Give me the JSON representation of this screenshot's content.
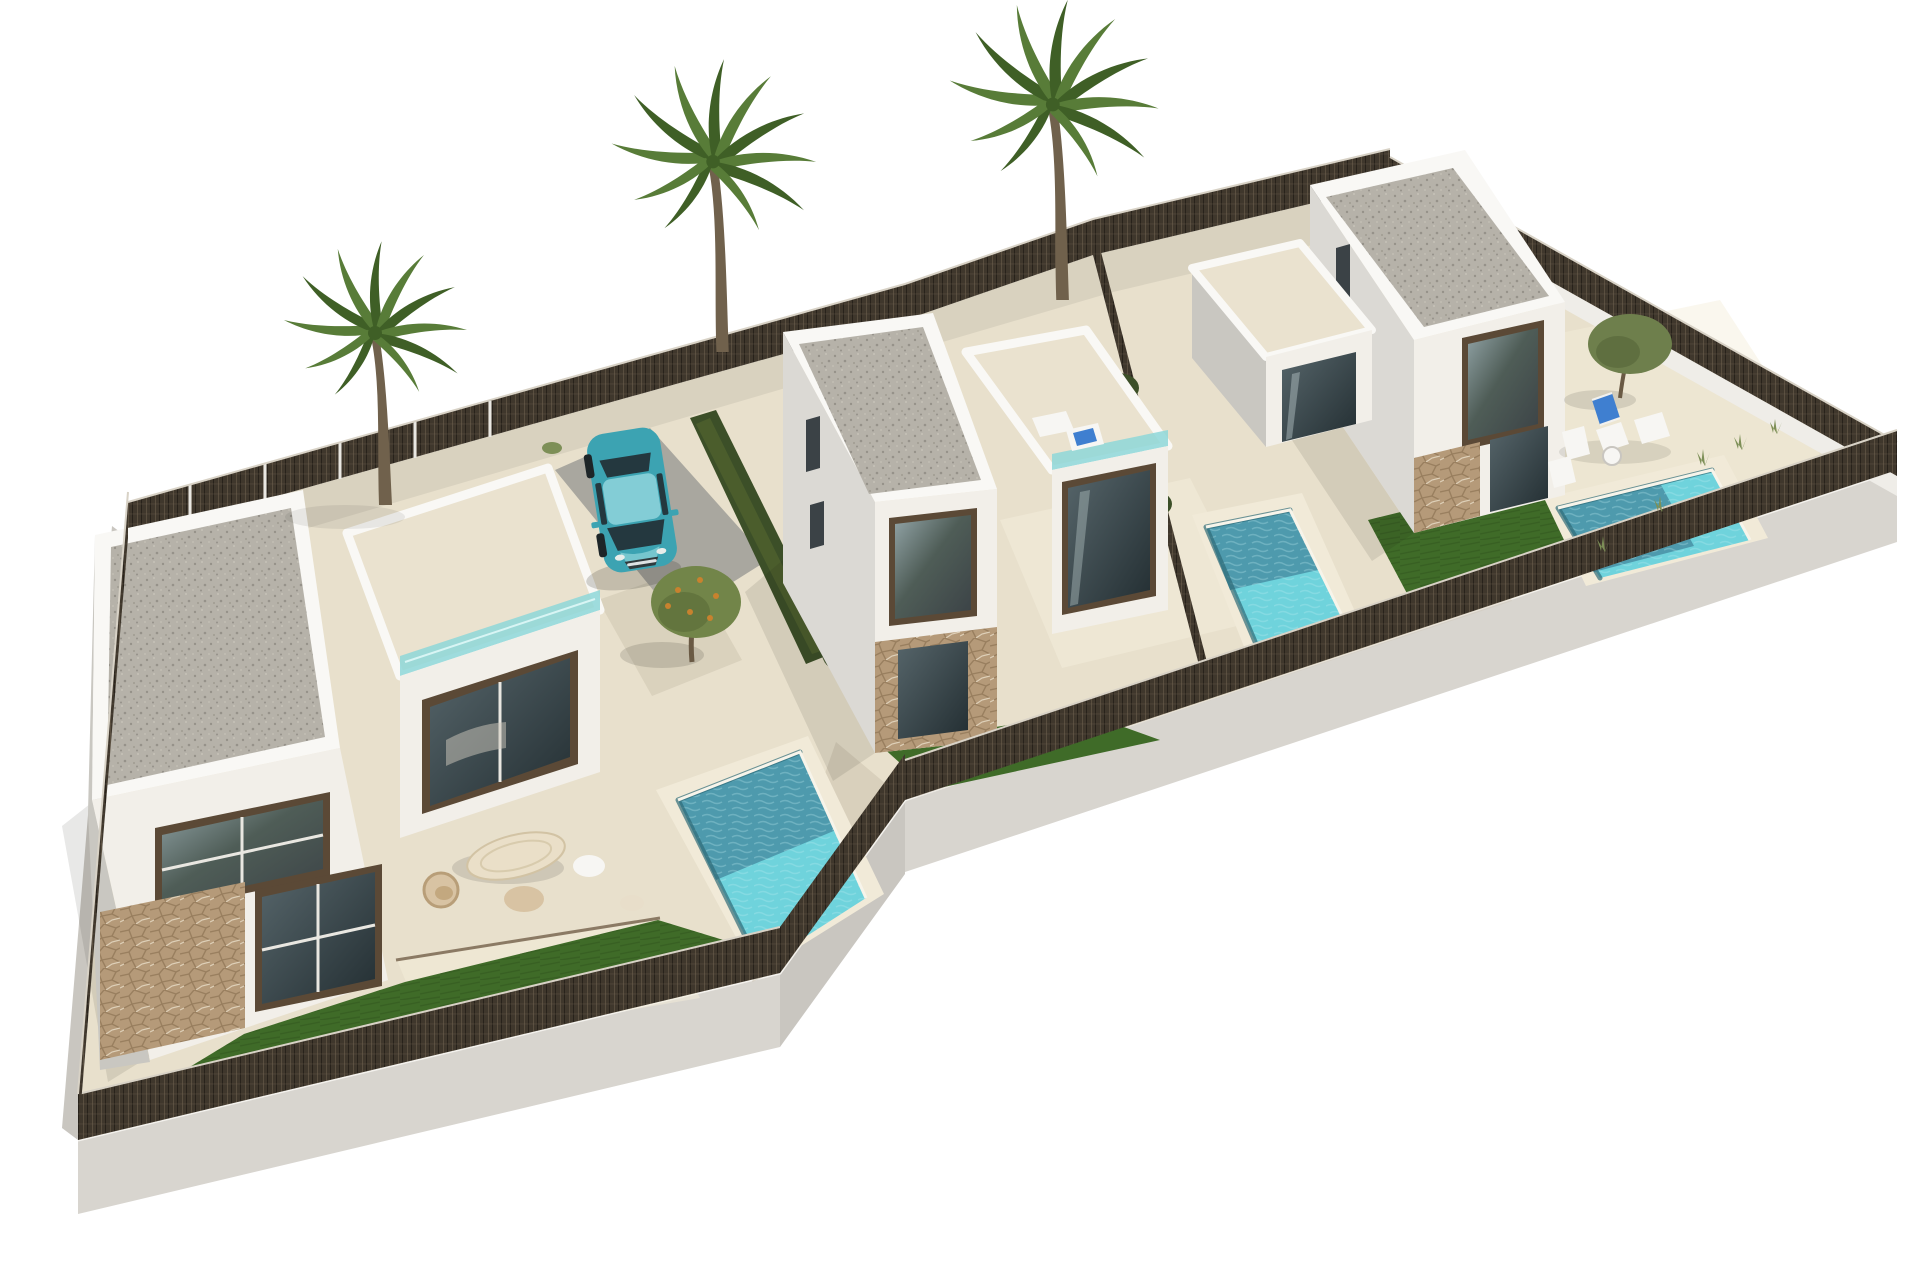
{
  "meta": {
    "title": "Aerial 3D rendering of three new-build villas with private pools",
    "media_type": "computer-generated architectural visualization",
    "view": "aerial isometric view on white background",
    "description": "Three modern two-storey white villas on a shared L-shaped plot model base. Each villa has a flat gravel roof with white parapet, stone cladding accents, a cream terrace, a turquoise private pool, artificial lawn and dark mesh perimeter fencing. Three tall palm trees stand behind the plots and a teal hatchback is parked in the driveway."
  },
  "scene": {
    "background": "#ffffff",
    "villas": [
      {
        "id": "villa-1",
        "position": "foreground left",
        "storeys": 2,
        "roof": "flat gravel roof with white parapet",
        "facade": "white render with natural stone cladding on ground floor",
        "outdoor": [
          "roof terrace with teal glass balustrade",
          "patio lounge furniture set",
          "private pool",
          "artificial lawn"
        ]
      },
      {
        "id": "villa-2",
        "position": "center",
        "storeys": 2,
        "roof": "flat gravel roof with white parapet",
        "facade": "white render with natural stone cladding on ground floor",
        "outdoor": [
          "roof terrace with sun lounger",
          "gravel driveway with parked car",
          "private pool",
          "lawn strip"
        ]
      },
      {
        "id": "villa-3",
        "position": "back right",
        "storeys": 2,
        "roof": "flat gravel roof with white parapet",
        "facade": "white render with natural stone cladding on ground floor",
        "outdoor": [
          "walled patio court",
          "sun loungers and bistro chairs",
          "private pool",
          "artificial lawn"
        ]
      }
    ],
    "pools": [
      {
        "villa": "villa-1",
        "shape": "rectangular",
        "water": "turquoise with darker deep end"
      },
      {
        "villa": "villa-2",
        "shape": "rectangular",
        "water": "turquoise with darker deep end"
      },
      {
        "villa": "villa-3",
        "shape": "rectangular",
        "water": "turquoise with darker deep end"
      }
    ],
    "palm_trees": [
      {
        "id": "palm-1",
        "location": "left boundary behind villa-1"
      },
      {
        "id": "palm-2",
        "location": "rear fence behind villa-2"
      },
      {
        "id": "palm-3",
        "location": "rear fence behind villa-3"
      }
    ],
    "small_trees": [
      {
        "type": "orange tree",
        "location": "court between villa-1 terrace and villa-2"
      },
      {
        "type": "olive tree",
        "location": "villa-3 garden near rear fence"
      }
    ],
    "car": {
      "type": "compact hatchback",
      "color": "teal",
      "location": "driveway beside villa-2",
      "heading": "nose toward viewer"
    },
    "fence": {
      "style": "dark woven mesh panels on low white base wall",
      "color": "#3f372c"
    },
    "base": {
      "style": "white concrete model plinth under the whole plot"
    },
    "colors": {
      "background": "#ffffff",
      "plinth_top": "#dedbd5",
      "plinth_front": "#d8d5cf",
      "plinth_side": "#c9c6c0",
      "ground_sand": "#e8e0cc",
      "ground_sand_light": "#f3edda",
      "ground_sand_shade": "#c9c0ab",
      "paving_gray": "#a9a79f",
      "lawn": "#3f6b28",
      "lawn_light": "#4f7f33",
      "pool_deck": "#f1ead8",
      "pool_deep": "#4e9aad",
      "pool_shallow": "#6fd3dc",
      "pool_wall": "#2f6b78",
      "pool_rim": "#f7f4ea",
      "fence_dark": "#3f372c",
      "fence_light": "#6e614f",
      "fence_rail": "#d8d2c6",
      "white_wall": "#efede8",
      "wall_sunlit": "#f2efe9",
      "wall_white": "#f9f8f5",
      "wall_shaded": "#dbd9d4",
      "wall_dark": "#c9c7c1",
      "roof_gravel": "#b6b2a9",
      "roof_gravel_dot": "#96928a",
      "stone": "#b59a79",
      "stone_dark": "#8d7354",
      "terrace_floor": "#eae2cf",
      "frame": "#5b4936",
      "glass_dark": "#3b4246",
      "glass_green": "#4f5d57",
      "glass_sky": "#93a5a8",
      "balustrade": "#8ed7d8",
      "hedge": "#3c4f28",
      "tree_olive": "#6e7f4c",
      "tree_orange": "#c8822e",
      "palm": "#587c38",
      "palm_dark": "#3f5f26",
      "trunk": "#70614c",
      "car_teal": "#3ca3b2",
      "car_teal_dark": "#22808f",
      "car_roof": "#83cdd6",
      "car_glass": "#24383f",
      "chrome": "#dde2e4",
      "towel": "#3f7fd0",
      "furn_white": "#f7f6f3",
      "furn_tan": "#d8c3a3",
      "shadow": "#1a1a18"
    }
  }
}
